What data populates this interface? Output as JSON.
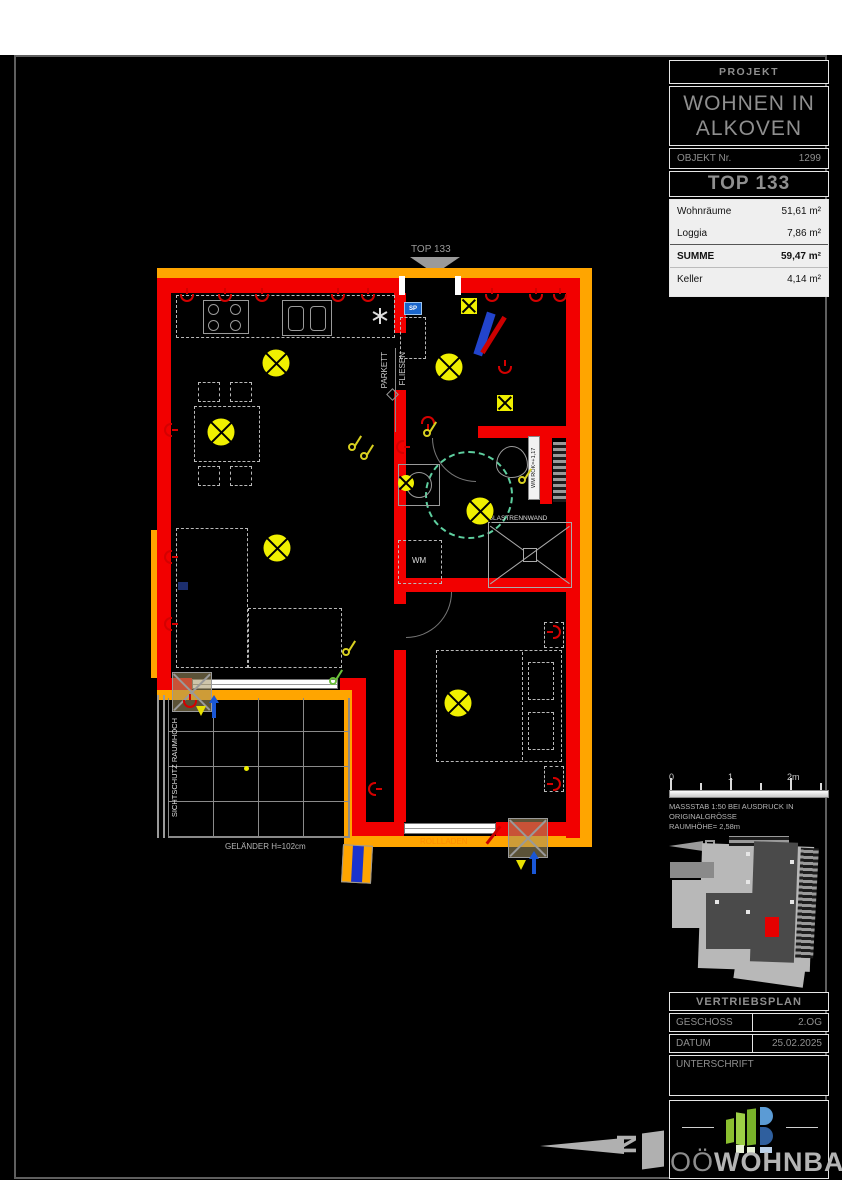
{
  "title_block": {
    "projekt_label": "PROJEKT",
    "project_name_line1": "WOHNEN IN",
    "project_name_line2": "ALKOVEN",
    "objekt_label": "OBJEKT Nr.",
    "objekt_value": "1299",
    "top_label": "TOP 133",
    "area_rows": [
      {
        "label": "Wohnräume",
        "value": "51,61 m²"
      },
      {
        "label": "Loggia",
        "value": "7,86 m²"
      },
      {
        "label": "SUMME",
        "value": "59,47 m²"
      },
      {
        "label": "Keller",
        "value": "4,14 m²"
      }
    ]
  },
  "scale_bar": {
    "tick_labels": [
      "0",
      "1",
      "2m"
    ],
    "note_line1": "MASSSTAB   1:50   BEI   AUSDRUCK   IN",
    "note_line2": "ORIGINALGRÖSSE",
    "note_line3": "RAUMHÖHE= 2,58m"
  },
  "footer": {
    "plan_type": "VERTRIEBSPLAN",
    "geschoss_label": "GESCHOSS",
    "geschoss_value": "2.OG",
    "datum_label": "DATUM",
    "datum_value": "25.02.2025",
    "unterschrift_label": "UNTERSCHRIFT"
  },
  "logo": {
    "text_light": "OÖ",
    "text_bold": "WOHNBAU"
  },
  "floorplan": {
    "entrance_label": "TOP 133",
    "labels": {
      "parkett": "PARKETT",
      "fliesen": "FLIESEN",
      "glastrennwand": "GLASTRENNWAND",
      "wm": "WM",
      "wm_rok": "WM ROK=+1,17",
      "sp": "SP",
      "gelaender": "GELÄNDER H=102cm",
      "rollladen": "ROLLLADEN",
      "sichtschutz": "SICHTSCHUTZ RAUMHOCH"
    },
    "colors": {
      "wall": "#f20000",
      "insulation": "#ffa500",
      "light": "#f0f000",
      "turning_circle": "#5ecf9f",
      "socket": "#d40000",
      "switch_yellow": "#d8d020",
      "switch_green": "#6abf3a",
      "door_blue": "#2244cc",
      "rollladen_text": "#ff8c00"
    },
    "symbols": {
      "lights": [
        {
          "x": 276,
          "y": 363,
          "t": "big"
        },
        {
          "x": 221,
          "y": 432,
          "t": "big"
        },
        {
          "x": 277,
          "y": 548,
          "t": "big"
        },
        {
          "x": 449,
          "y": 367,
          "t": "big"
        },
        {
          "x": 480,
          "y": 511,
          "t": "big"
        },
        {
          "x": 458,
          "y": 703,
          "t": "big"
        },
        {
          "x": 406,
          "y": 483,
          "t": "small"
        },
        {
          "x": 505,
          "y": 403,
          "t": "square"
        },
        {
          "x": 469,
          "y": 306,
          "t": "square"
        }
      ],
      "sockets": [
        {
          "x": 187,
          "y": 298,
          "r": 0
        },
        {
          "x": 225,
          "y": 298,
          "r": 0
        },
        {
          "x": 262,
          "y": 298,
          "r": 0
        },
        {
          "x": 338,
          "y": 298,
          "r": 0
        },
        {
          "x": 368,
          "y": 298,
          "r": 0
        },
        {
          "x": 492,
          "y": 298,
          "r": 0
        },
        {
          "x": 536,
          "y": 298,
          "r": 0
        },
        {
          "x": 560,
          "y": 298,
          "r": 0
        },
        {
          "x": 168,
          "y": 430,
          "r": 90
        },
        {
          "x": 168,
          "y": 557,
          "r": 90
        },
        {
          "x": 168,
          "y": 624,
          "r": 90
        },
        {
          "x": 400,
          "y": 447,
          "r": 90
        },
        {
          "x": 505,
          "y": 370,
          "r": 0
        },
        {
          "x": 428,
          "y": 420,
          "r": 180
        },
        {
          "x": 557,
          "y": 632,
          "r": 270
        },
        {
          "x": 557,
          "y": 784,
          "r": 270
        },
        {
          "x": 372,
          "y": 789,
          "r": 90
        },
        {
          "x": 190,
          "y": 704,
          "r": 0
        }
      ],
      "switches": [
        {
          "x": 352,
          "y": 447,
          "c": "#d8d020"
        },
        {
          "x": 364,
          "y": 456,
          "c": "#d8d020"
        },
        {
          "x": 346,
          "y": 652,
          "c": "#d8d020"
        },
        {
          "x": 333,
          "y": 681,
          "c": "#6abf3a"
        },
        {
          "x": 522,
          "y": 480,
          "c": "#d8d020"
        },
        {
          "x": 427,
          "y": 433,
          "c": "#d8d020"
        }
      ]
    }
  }
}
